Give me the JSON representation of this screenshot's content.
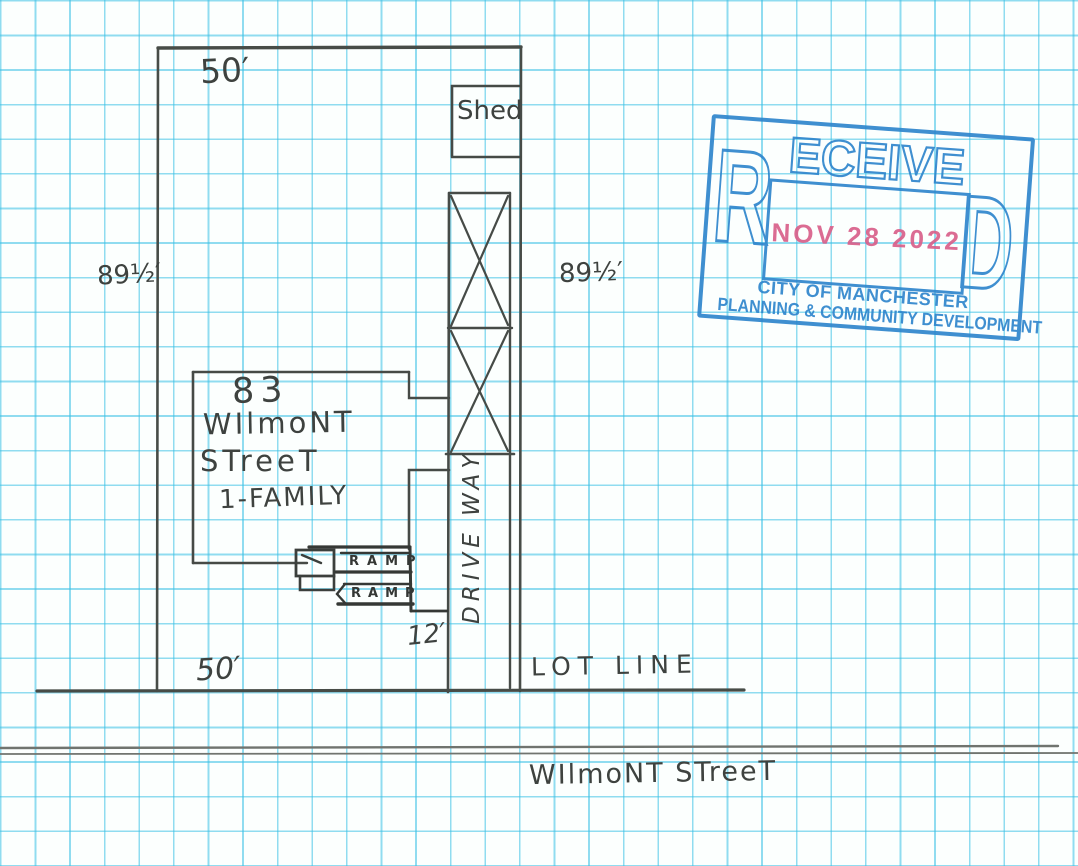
{
  "plan": {
    "dimensions": {
      "top": "50′",
      "bottom": "50′",
      "left": "89½′",
      "right": "89½′",
      "ramp_width": "12′"
    },
    "shed_label": "Shed",
    "house": {
      "number": "83",
      "street_line1": "WIlmoNT",
      "street_line2": "STreeT",
      "type": "1-FAMILY"
    },
    "ramp_upper_label": "RAMP",
    "ramp_lower_label": "RAMP",
    "driveway_label": "DRIVE WAY",
    "lot_line_label": "LOT LINE",
    "street_name": "WIlmoNT STreeT"
  },
  "stamp": {
    "word_left": "R",
    "word_middle": "ECEIVE",
    "word_right": "D",
    "date": "NOV 28 2022",
    "agency": "CITY OF MANCHESTER",
    "department": "PLANNING & COMMUNITY DEVELOPMENT",
    "colors": {
      "ink": "#2f86cd",
      "date_ink": "#d9608a"
    }
  },
  "paper": {
    "grid_color": "#38c0e5",
    "pencil_color": "#4b4f4b"
  }
}
